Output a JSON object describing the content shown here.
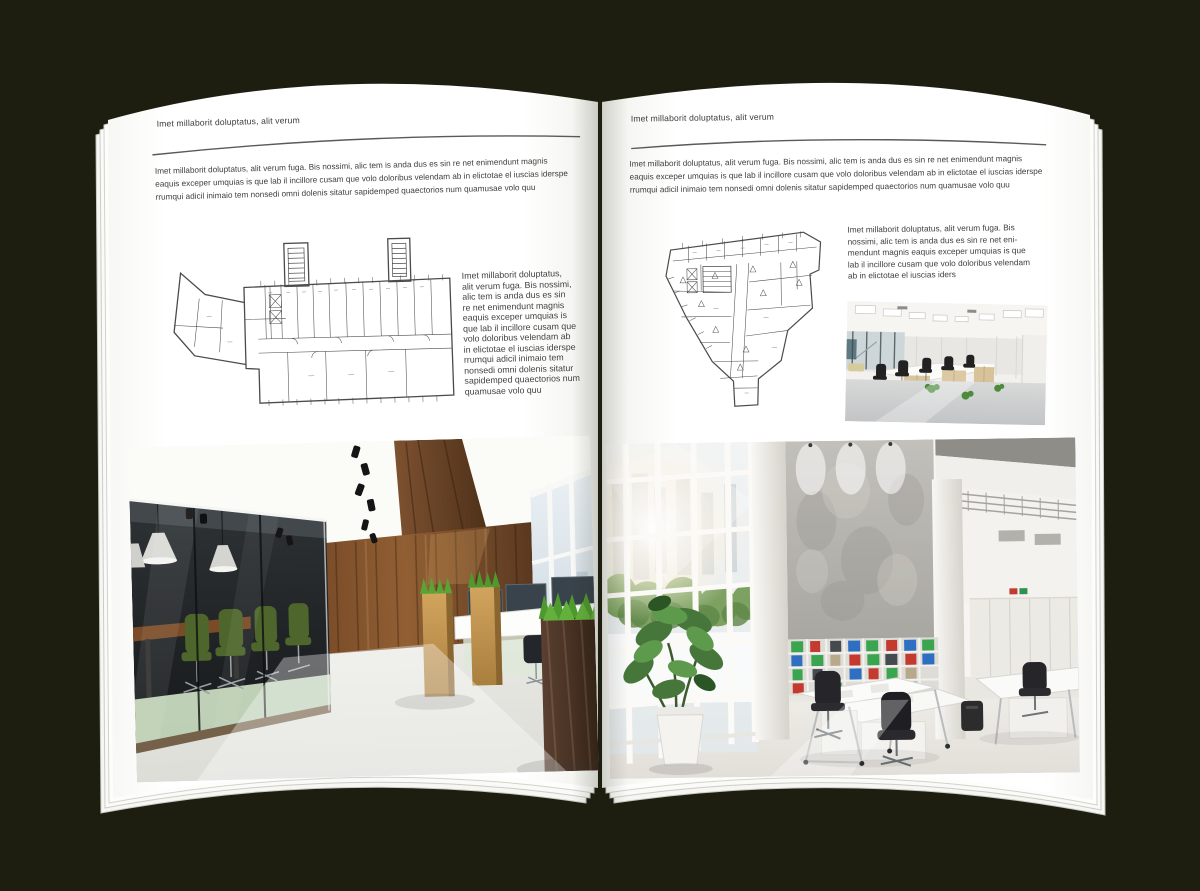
{
  "scene": {
    "description": "Open interior-design magazine spread mockup lying on a dark background",
    "background_color": "#1e1e10",
    "page_color": "#ffffff"
  },
  "palette": {
    "text": "#3f3f3f",
    "rule_line": "#5a5a5a",
    "plan_line": "#4b4b4b",
    "wood_wall": "#7a4e28",
    "walnut": "#49301d",
    "oak_planter": "#c89a55",
    "grass_green": "#55a032",
    "chair_green": "#4e662c",
    "binder_green": "#3aa44f",
    "binder_red": "#c43a2e",
    "binder_blue": "#2f6fc2"
  },
  "left_page": {
    "header": "Imet millaborit doluptatus, alit verum",
    "intro_lines": [
      "Imet millaborit doluptatus, alit verum fuga. Bis nossimi, alic tem is anda dus es sin re net enimendunt magnis",
      "eaquis exceper umquias is que lab il incillore cusam que volo doloribus velendam ab in elictotae el iuscias iderspe",
      "rrumqui adicil inimaio tem nonsedi omni dolenis sitatur sapidemped quaectorios num quamusae volo quu"
    ],
    "side_text_lines": [
      "Imet millaborit doluptatus,",
      "alit verum fuga. Bis nossimi,",
      "alic tem is anda dus es sin",
      "re net enimendunt magnis",
      "eaquis exceper umquias is",
      "que lab il incillore cusam que",
      "volo doloribus velendam ab",
      "in elictotae el iuscias iderspe",
      "rrumqui adicil inimaio tem",
      "nonsedi omni dolenis sitatur",
      "sapidemped quaectorios num",
      "quamusae volo quu"
    ],
    "floorplan": "wide-office-building-plan-with-two-stair-towers",
    "photo": "office-interior-dark-glass-meeting-room-green-chairs-wood-wall"
  },
  "right_page": {
    "header": "Imet millaborit doluptatus, alit verum",
    "intro_lines": [
      "Imet millaborit doluptatus, alit verum fuga. Bis nossimi, alic tem is anda dus es sin re net enimendunt magnis",
      "eaquis exceper umquias is que lab il incillore cusam que volo doloribus velendam ab in elictotae el iuscias iderspe",
      "rrumqui adicil inimaio tem nonsedi omni dolenis sitatur sapidemped quaectorios num quamusae volo quu"
    ],
    "side_text_lines": [
      "Imet millaborit doluptatus, alit verum fuga. Bis",
      "nossimi, alic tem is anda dus es sin re net eni-",
      "mendunt magnis eaquis exceper umquias is que",
      "lab il incillore cusam que volo doloribus velendam",
      "ab in elictotae el iuscias iders"
    ],
    "floorplan": "irregular-tapering-office-building-plan",
    "photo_small": "open-plan-office-white-ceiling-wood-cabinets",
    "photo_large": "tall-white-atrium-office-binder-shelves-plant"
  }
}
